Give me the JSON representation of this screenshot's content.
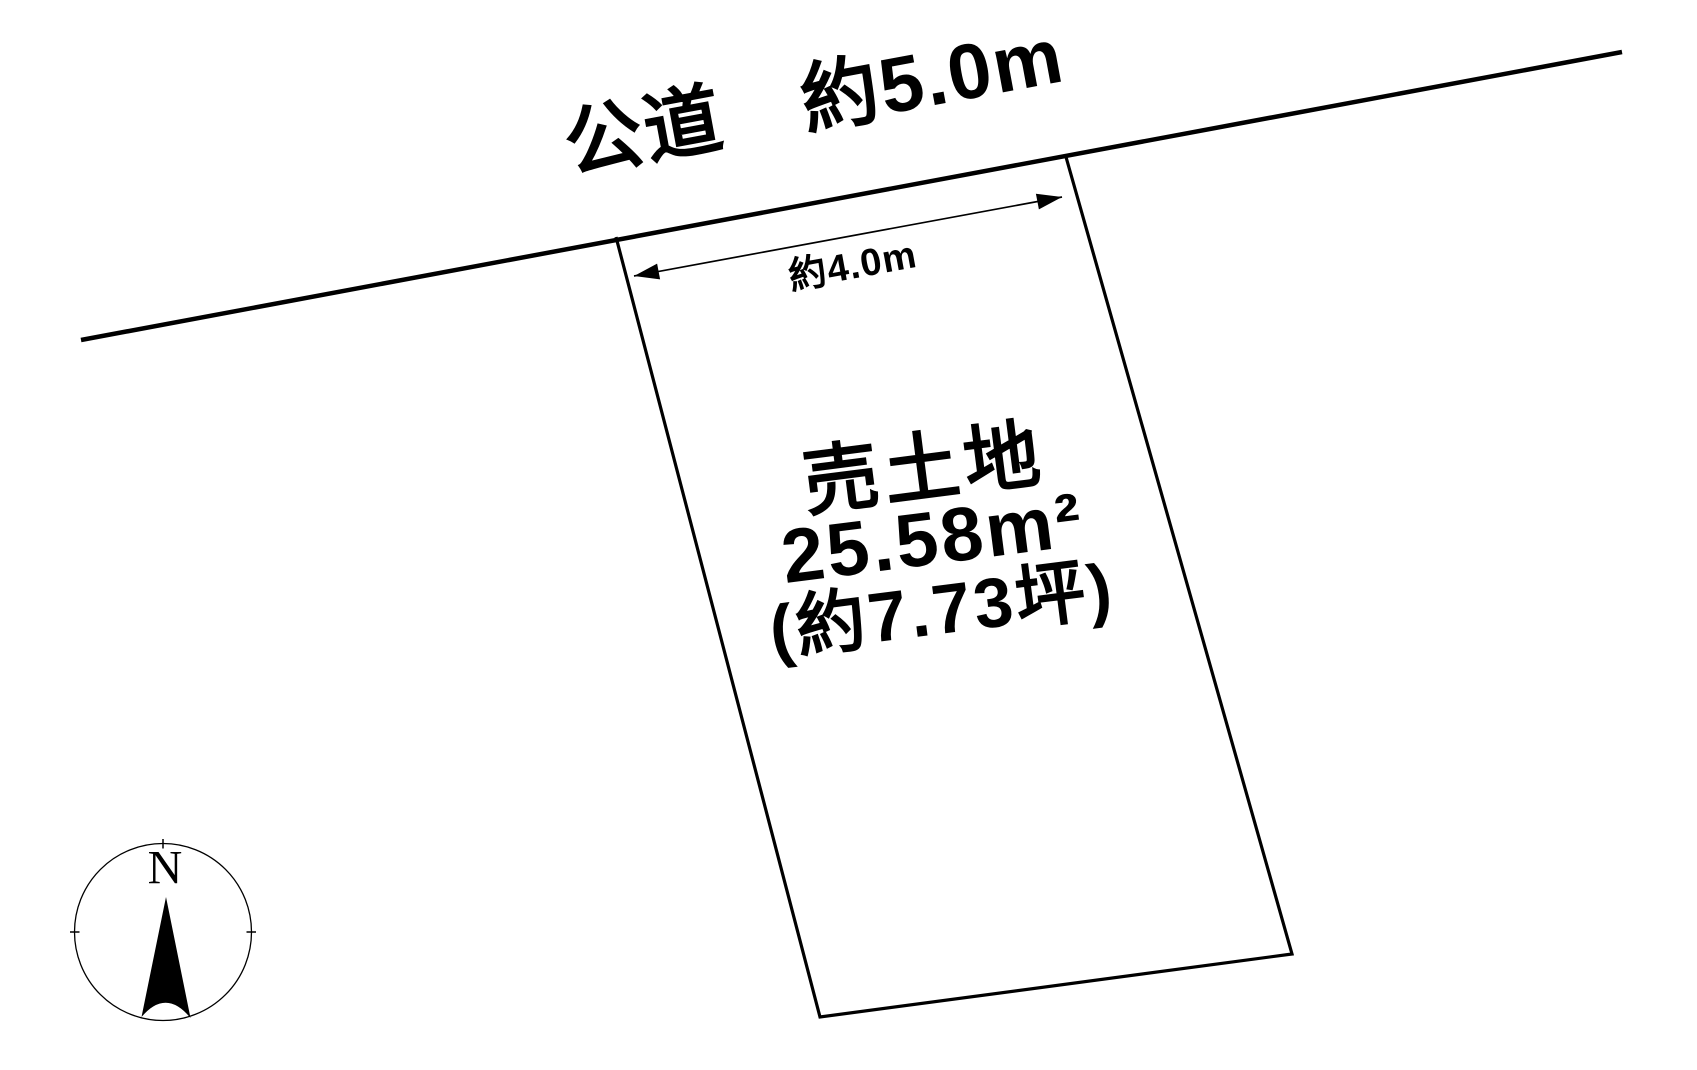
{
  "page": {
    "background_color": "#ffffff",
    "line_color": "#000000",
    "text_color": "#000000"
  },
  "road": {
    "label": "公道　約5.0m"
  },
  "frontage": {
    "label": "約4.0m"
  },
  "parcel": {
    "title": "売土地",
    "area_sqm": "25.58m²",
    "area_tsubo": "(約7.73坪)"
  },
  "compass": {
    "north": "N"
  }
}
